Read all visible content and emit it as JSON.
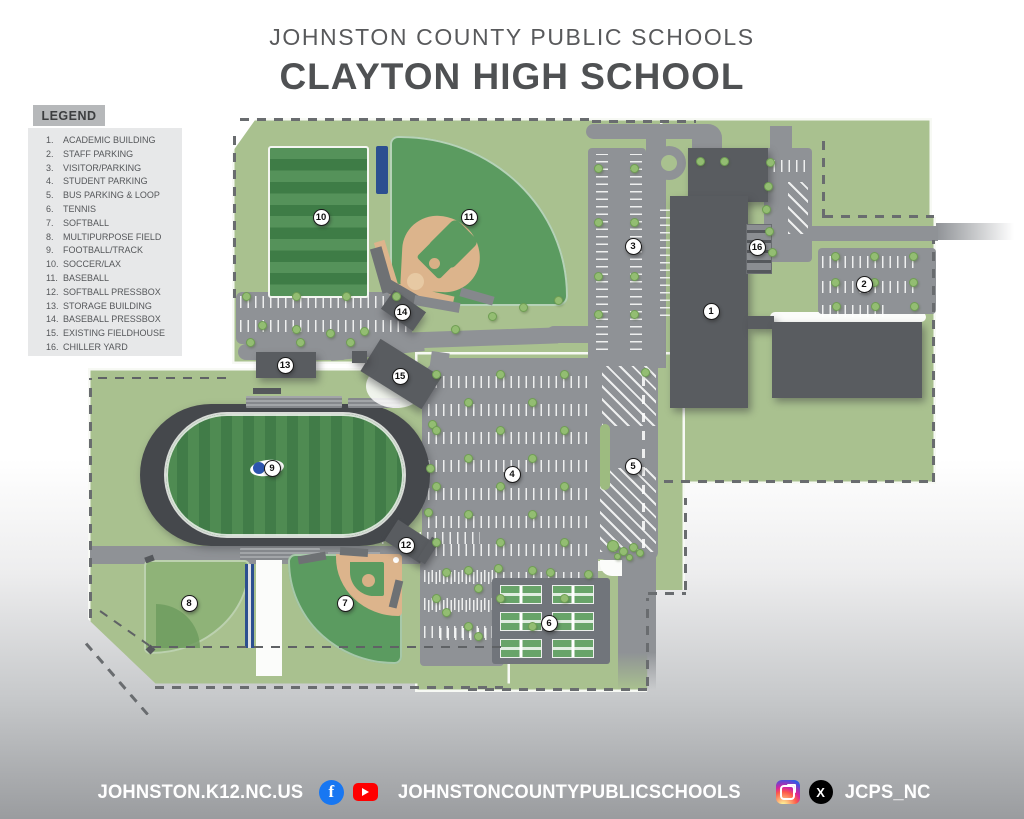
{
  "title": {
    "district": "JOHNSTON COUNTY PUBLIC SCHOOLS",
    "school": "CLAYTON HIGH SCHOOL"
  },
  "legend": {
    "title": "LEGEND",
    "items": [
      {
        "num": "1.",
        "label": "ACADEMIC BUILDING"
      },
      {
        "num": "2.",
        "label": "STAFF PARKING"
      },
      {
        "num": "3.",
        "label": "VISITOR/PARKING"
      },
      {
        "num": "4.",
        "label": "STUDENT PARKING"
      },
      {
        "num": "5.",
        "label": "BUS PARKING & LOOP"
      },
      {
        "num": "6.",
        "label": "TENNIS"
      },
      {
        "num": "7.",
        "label": "SOFTBALL"
      },
      {
        "num": "8.",
        "label": "MULTIPURPOSE FIELD"
      },
      {
        "num": "9.",
        "label": "FOOTBALL/TRACK"
      },
      {
        "num": "10.",
        "label": "SOCCER/LAX"
      },
      {
        "num": "11.",
        "label": "BASEBALL"
      },
      {
        "num": "12.",
        "label": "SOFTBALL PRESSBOX"
      },
      {
        "num": "13.",
        "label": "STORAGE BUILDING"
      },
      {
        "num": "14.",
        "label": "BASEBALL PRESSBOX"
      },
      {
        "num": "15.",
        "label": "EXISTING FIELDHOUSE"
      },
      {
        "num": "16.",
        "label": "CHILLER YARD"
      }
    ]
  },
  "map": {
    "stadium_left_text": "COMETS",
    "stadium_right_text": "CLAYTON",
    "markers": [
      {
        "num": "1",
        "label": "ACADEMIC BUILDING",
        "x": 711,
        "y": 311
      },
      {
        "num": "2",
        "label": "STAFF PARKING",
        "x": 864,
        "y": 284
      },
      {
        "num": "3",
        "label": "VISITOR/PARKING",
        "x": 633,
        "y": 246
      },
      {
        "num": "4",
        "label": "STUDENT PARKING",
        "x": 512,
        "y": 474
      },
      {
        "num": "5",
        "label": "BUS PARKING & LOOP",
        "x": 633,
        "y": 466
      },
      {
        "num": "6",
        "label": "TENNIS",
        "x": 549,
        "y": 623
      },
      {
        "num": "7",
        "label": "SOFTBALL",
        "x": 345,
        "y": 603
      },
      {
        "num": "8",
        "label": "MULTIPURPOSE FIELD",
        "x": 189,
        "y": 603
      },
      {
        "num": "9",
        "label": "FOOTBALL/TRACK",
        "x": 272,
        "y": 468
      },
      {
        "num": "10",
        "label": "SOCCER/LAX",
        "x": 321,
        "y": 217
      },
      {
        "num": "11",
        "label": "BASEBALL",
        "x": 469,
        "y": 217
      },
      {
        "num": "12",
        "label": "SOFTBALL PRESSBOX",
        "x": 406,
        "y": 545
      },
      {
        "num": "13",
        "label": "STORAGE BUILDING",
        "x": 285,
        "y": 365
      },
      {
        "num": "14",
        "label": "BASEBALL PRESSBOX",
        "x": 402,
        "y": 312
      },
      {
        "num": "15",
        "label": "EXISTING FIELDHOUSE",
        "x": 400,
        "y": 376
      },
      {
        "num": "16",
        "label": "CHILLER YARD",
        "x": 757,
        "y": 247
      }
    ]
  },
  "footer": {
    "website": "JOHNSTON.K12.NC.US",
    "social_handle": "JOHNSTONCOUNTYPUBLICSCHOOLS",
    "twitter_handle": "JCPS_NC",
    "facebook_letter": "f",
    "x_letter": "X"
  },
  "colors": {
    "campus_green": "#a9c18f",
    "field_green": "#5b9b60",
    "infield_tan": "#dcb48c",
    "road_gray": "#8f9296",
    "building_gray": "#595c60",
    "endzone_blue": "#3a67c2",
    "bleacher_navy": "#2c4f90",
    "title_gray": "#58595b",
    "facebook_blue": "#1877f2",
    "youtube_red": "#ff0000",
    "x_black": "#000000"
  }
}
